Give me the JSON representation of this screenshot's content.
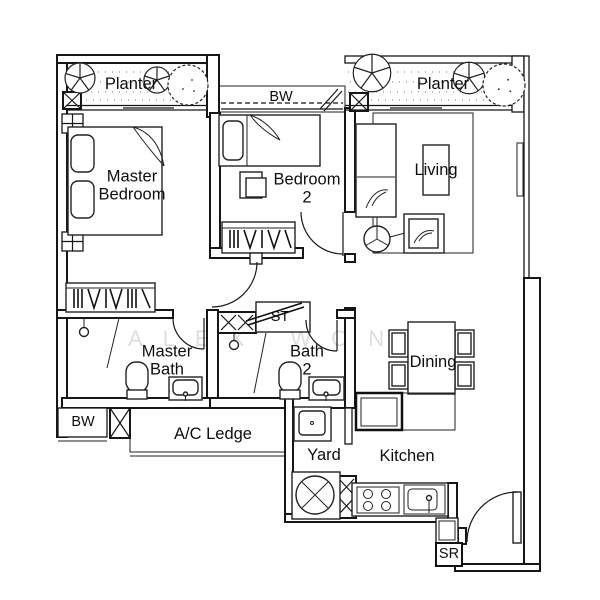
{
  "meta": {
    "type": "apartment-floor-plan"
  },
  "colors": {
    "paper": "#ffffff",
    "line": "#161616",
    "watermark": "#dedede"
  },
  "watermark": {
    "text": "ALEX WONG"
  },
  "labels": {
    "planter_left": {
      "text": "Planter"
    },
    "bw_top": {
      "text": "BW"
    },
    "planter_right": {
      "text": "Planter"
    },
    "master_bedroom": {
      "text": "Master\nBedroom"
    },
    "bedroom_2": {
      "text": "Bedroom\n2"
    },
    "living": {
      "text": "Living"
    },
    "st": {
      "text": "ST"
    },
    "master_bath": {
      "text": "Master\nBath"
    },
    "bath_2": {
      "text": "Bath\n2"
    },
    "dining": {
      "text": "Dining"
    },
    "bw_bottom": {
      "text": "BW"
    },
    "ac_ledge": {
      "text": "A/C Ledge"
    },
    "yard": {
      "text": "Yard"
    },
    "kitchen": {
      "text": "Kitchen"
    },
    "sr": {
      "text": "SR"
    }
  }
}
